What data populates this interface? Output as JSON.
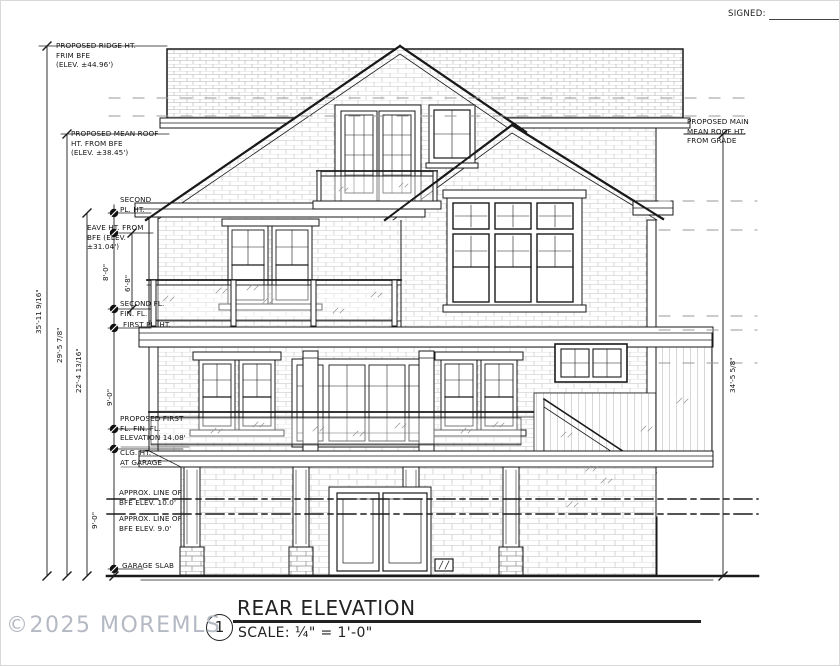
{
  "page": {
    "signed_label": "SIGNED:"
  },
  "watermark": {
    "text": "©2025 MOREMLS",
    "color": "#b4b9c3"
  },
  "title_block": {
    "number": "1",
    "title": "REAR ELEVATION",
    "scale": "SCALE: ¼\"  =  1'-0\""
  },
  "annotations": {
    "ridge": "PROPOSED RIDGE HT.\nFRIM BFE\n(ELEV. ±44.96')",
    "mean_roof": "PROPOSED MEAN ROOF\nHT. FROM BFE\n(ELEV. ±38.45')",
    "second_pl": "SECOND\nPL. HT.",
    "eave": "EAVE HT. FROM\nBFE (ELEV.\n±31.04')",
    "second_fl": "SECOND FL.\nFIN. FL.",
    "first_pl": "FIRST PL. HT.",
    "first_fl": "PROPOSED FIRST\nFL. FIN. FL.\nELEVATION 14.08'",
    "clg_garage": "CLG. HT.\nAT GARAGE",
    "bfe10": "APPROX. LINE OF\nBFE ELEV. 10.0'",
    "bfe9": "APPROX. LINE OF\nBFE ELEV. 9.0'",
    "garage_slab": "GARAGE SLAB",
    "main_roof": "PROPOSED MAIN\nMEAN ROOF HT.\nFROM GRADE"
  },
  "dimensions": {
    "total_height": "35'-11 9/16\"",
    "mean_roof_height": "29'-5 7/8\"",
    "mid_height": "22'-4 13/16\"",
    "second_story": "8'-0\"",
    "eave_to_floor": "6'-8\"",
    "first_story": "9'-0\"",
    "garage_story": "9'-0\"",
    "right_total": "34'-5 5/8\""
  }
}
